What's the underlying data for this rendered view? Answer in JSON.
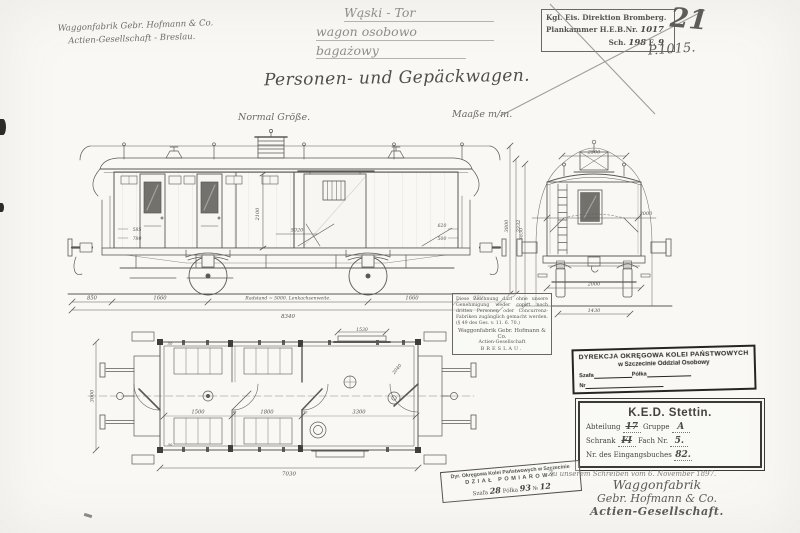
{
  "header": {
    "maker_note": {
      "line1": "Waggonfabrik Gebr. Hofmann & Co.",
      "line2": "Actien-Gesellschaft - Breslau."
    },
    "pencil_note": {
      "line1": "Wąski - Tor",
      "line2": "wagon osobowo",
      "line3": "bagażowy"
    },
    "bromberg_stamp": {
      "line1": "Kgl. Eis. Direktion Bromberg.",
      "line2_label": "Plankammer H.E.B.Nr.",
      "line2_value": "1017",
      "line3_label": "Sch.",
      "line3_value": "198",
      "line3_label2": "F.",
      "line3_value2": "9"
    },
    "big_number": "21",
    "plan_number": "P.1015."
  },
  "title": "Personen- und Gepäckwagen.",
  "labels": {
    "scale": "Normal Größe.",
    "units": "Maaße m/m."
  },
  "side_elevation": {
    "d_left_overhang": "850",
    "d_left_axle": "1660",
    "d_radstand": "Radstand = 5000. Lenkachsenweite.",
    "d_right_axle": "1660",
    "d_right_overhang": "650",
    "d_total": "8340",
    "d_body_height": "2100",
    "d_floor": "5020",
    "d_small_l1": "585",
    "d_small_l2": "780",
    "d_small_r1": "620",
    "d_small_r2": "500",
    "d_height1": "3800",
    "d_height2": "3332"
  },
  "end_view": {
    "d_roof": "2500",
    "d_body": "3000",
    "d_frame": "2000",
    "d_gauge": "1430",
    "d_height": "3850"
  },
  "plan_view": {
    "d_c1": "1500",
    "d_w1": "90",
    "d_c2": "1800",
    "d_w2": "30",
    "d_c3": "3300",
    "d_total": "7030",
    "d_width": "3000",
    "d_slide": "1530",
    "d_diag": "2040",
    "d_50a": "50",
    "d_50b": "50"
  },
  "notice_box": {
    "text": "Diese Zeichnung darf ohne unsere Genehmigung weder copirt noch dritten Personen oder Concurrenz-Fabriken zugänglich gemacht werden. (§ 49 des Ges. v. 11. 6. 70.)",
    "company": "Waggonfabrik Gebr. Hofmann & Co.",
    "company2": "Actien-Gesellschaft",
    "city": "BRESLAU."
  },
  "stamps": {
    "polish_bold": {
      "line1": "DYREKCJA OKRĘGOWA KOLEI PAŃSTWOWYCH",
      "line2": "w Szczecinie Oddział Osobowy",
      "szafa_label": "Szafa",
      "polka_label": "Półka",
      "nr_label": "Nr"
    },
    "ked": {
      "title": "K.E.D. Stettin.",
      "row1_label1": "Abteilung",
      "row1_value1": "17",
      "row1_label2": "Gruppe",
      "row1_value2": "A",
      "row2_label1": "Schrank",
      "row2_value1": "FI",
      "row2_label2": "Fach Nr.",
      "row2_value2": "5.",
      "row3_label": "Nr. des Eingangsbuches",
      "row3_value": "82."
    },
    "tilted": {
      "line1": "Dyr. Okręgowa Kolei Państwowych w Szczecinie",
      "line2": "DZIAŁ POMIAROWY",
      "szafa_label": "Szafa",
      "szafa_value": "28",
      "polka_label": "Półka",
      "polka_value": "93",
      "nr_label": "№",
      "nr_value": "12"
    }
  },
  "signature": {
    "ref_line": "Zu unserem Schreiben vom 6. November 1897.",
    "line1": "Waggonfabrik",
    "line2": "Gebr. Hofmann & Co.",
    "line3": "Actien-Gesellschaft."
  }
}
